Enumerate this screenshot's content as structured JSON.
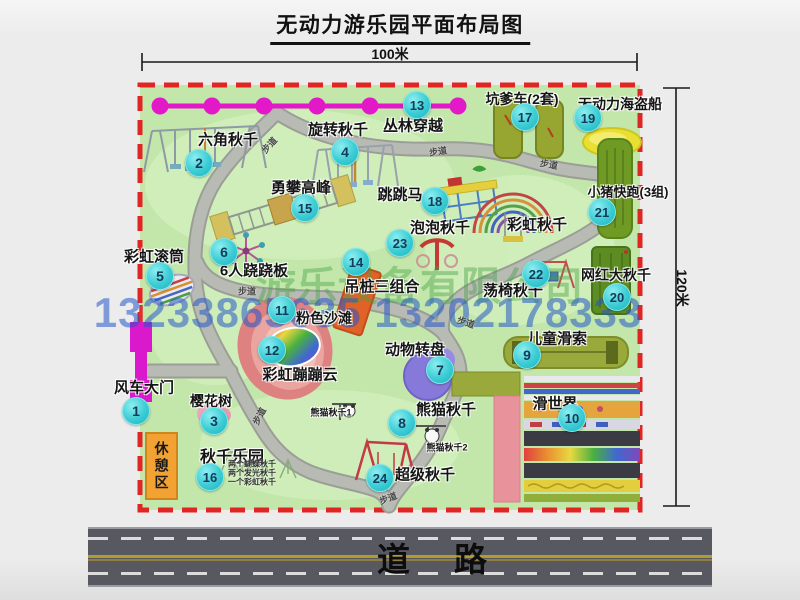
{
  "title": "无动力游乐园平面布局图",
  "scale": {
    "width": "100米",
    "height": "120米"
  },
  "road": {
    "label": "道路"
  },
  "trail_label": "步道",
  "watermark": {
    "company": "游乐设备有限公司",
    "phone": "13233865635 13202178333"
  },
  "attractions": [
    {
      "num": "1",
      "name": "风车大门"
    },
    {
      "num": "2",
      "name": "六角秋千"
    },
    {
      "num": "3",
      "name": "樱花树"
    },
    {
      "num": "4",
      "name": "旋转秋千"
    },
    {
      "num": "5",
      "name": "彩虹滚筒"
    },
    {
      "num": "6",
      "name": "6人跷跷板"
    },
    {
      "num": "7",
      "name": "动物转盘"
    },
    {
      "num": "8",
      "name": "熊猫秋千"
    },
    {
      "num": "9",
      "name": "儿童滑索"
    },
    {
      "num": "10",
      "name": "滑世界"
    },
    {
      "num": "11",
      "name": "粉色沙滩"
    },
    {
      "num": "12",
      "name": "彩虹蹦蹦云"
    },
    {
      "num": "13",
      "name": "丛林穿越"
    },
    {
      "num": "14",
      "name": "吊桩三组合"
    },
    {
      "num": "15",
      "name": "勇攀高峰"
    },
    {
      "num": "16",
      "name": "秋千乐园"
    },
    {
      "num": "17",
      "name": "坑爹车(2套)"
    },
    {
      "num": "18",
      "name": "跳跳马"
    },
    {
      "num": "19",
      "name": "无动力海盗船"
    },
    {
      "num": "20",
      "name": "网红大秋千"
    },
    {
      "num": "21",
      "name": "小猪快跑(3组)"
    },
    {
      "num": "22",
      "name": "荡椅秋千"
    },
    {
      "num": "23",
      "name": "泡泡秋千"
    },
    {
      "num": "24",
      "name": "超级秋千"
    }
  ],
  "unnumbered_labels": {
    "rainbow_swing": "彩虹秋千",
    "rest_area": "休憩区",
    "panda_swing_1": "熊猫秋千1",
    "panda_swing_2": "熊猫秋千2"
  },
  "swing_park_notes": [
    "两个蝴蝶秋千",
    "两个发光秋千",
    "一个彩虹秋千"
  ]
}
